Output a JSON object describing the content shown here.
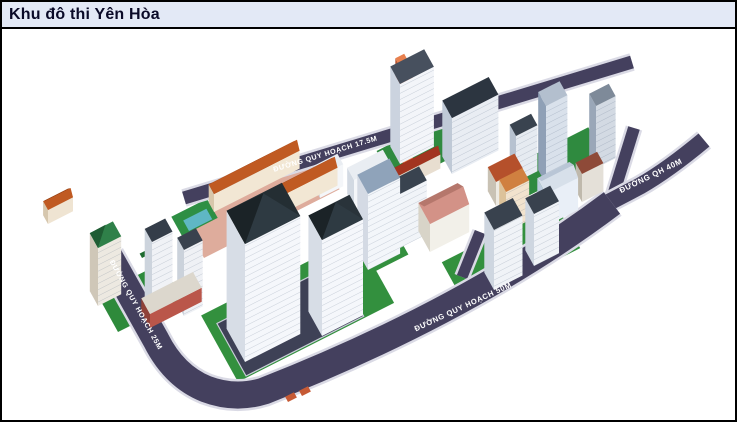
{
  "window": {
    "title": "Khu đô thi Yên Hòa"
  },
  "colors": {
    "titlebar_bg": "#E3E9F6",
    "titlebar_text": "#0A0A28",
    "frame_border": "#000000",
    "canvas_bg": "#FFFFFF",
    "road": "#44405E",
    "sidewalk": "#DADAE5",
    "road_label_text": "#FFFFFF",
    "grass": "#33903E",
    "grass_dark": "#1D6B2F",
    "water": "#5FB7C4",
    "townhouse_roof": "#C05A22",
    "tower_roof_dark": "#27313A",
    "salmon_roof": "#D39287",
    "parking": "#3E4156"
  },
  "scene": {
    "road_labels": [
      {
        "id": "road-label-25m",
        "text": "ĐƯỜNG QUY HOẠCH 25M",
        "x": 134,
        "y": 306,
        "angle": 61,
        "size": 7.2
      },
      {
        "id": "road-label-17-5m",
        "text": "ĐƯỜNG QUY HOẠCH 17.5M",
        "x": 326,
        "y": 156,
        "angle": -17,
        "size": 7.2
      },
      {
        "id": "road-label-50m",
        "text": "ĐƯỜNG QUY HOẠCH 50M",
        "x": 464,
        "y": 309,
        "angle": -25,
        "size": 7.6
      },
      {
        "id": "road-label-40m",
        "text": "ĐƯỜNG QH 40M",
        "x": 652,
        "y": 178,
        "angle": -26,
        "size": 7.8
      }
    ],
    "roads": [
      {
        "name": "road-17-5m",
        "d": "M 184 198 L 632 62",
        "w": 13
      },
      {
        "name": "road-branch-internal",
        "d": "M 462 277 L 480 232",
        "w": 11
      },
      {
        "name": "road-junction-arm",
        "d": "M 611 202 L 634 128",
        "w": 12
      },
      {
        "name": "road-40m",
        "d": "M 600 207 L 640 186 Q 668 170 704 140",
        "w": 17
      },
      {
        "name": "road-25m-50m-loop",
        "d": "M 109 256 L 156 340 Q 174 376 206 389 Q 235 400 264 391 Q 470 310 612 203",
        "w": 27
      }
    ],
    "pads": [
      {
        "name": "lawn-left",
        "x": 118,
        "y": 332,
        "w": 72,
        "d": 42,
        "fill": "#2E8A3B"
      },
      {
        "name": "lawn-central",
        "x": 238,
        "y": 382,
        "w": 175,
        "d": 76,
        "fill": "#33903E"
      },
      {
        "name": "parking-central",
        "x": 246,
        "y": 376,
        "w": 132,
        "d": 60,
        "fill": "#3E4156",
        "stroke": "#C9CCD8"
      },
      {
        "name": "lawn-center-small",
        "x": 362,
        "y": 278,
        "w": 52,
        "d": 30,
        "fill": "#33903E"
      },
      {
        "name": "townhouse-ground",
        "x": 204,
        "y": 258,
        "w": 152,
        "d": 38,
        "fill": "#DEAC9C"
      },
      {
        "name": "lawn-upper-a",
        "x": 396,
        "y": 186,
        "w": 110,
        "d": 40,
        "fill": "#2F8A3F"
      },
      {
        "name": "lawn-upper-b",
        "x": 520,
        "y": 200,
        "w": 95,
        "d": 34,
        "fill": "#2F8A3F"
      },
      {
        "name": "lawn-right",
        "x": 466,
        "y": 306,
        "w": 128,
        "d": 50,
        "fill": "#33903E"
      }
    ],
    "pool": {
      "frame": {
        "x": 182,
        "y": 236,
        "w": 40,
        "d": 22,
        "fill": "#2E8F44"
      },
      "water": {
        "x": 189,
        "y": 231,
        "w": 26,
        "d": 12,
        "fill": "#5FB7C4"
      }
    },
    "trees": [
      {
        "x": 142,
        "y": 258,
        "w": 8,
        "d": 5,
        "fill": "#1D6B2F"
      },
      {
        "x": 150,
        "y": 272,
        "w": 8,
        "d": 5,
        "fill": "#1D6B2F"
      },
      {
        "x": 158,
        "y": 287,
        "w": 8,
        "d": 5,
        "fill": "#1D6B2F"
      },
      {
        "x": 166,
        "y": 301,
        "w": 8,
        "d": 5,
        "fill": "#1D6B2F"
      },
      {
        "x": 288,
        "y": 402,
        "w": 10,
        "d": 6,
        "fill": "#C65A35"
      },
      {
        "x": 302,
        "y": 396,
        "w": 10,
        "d": 6,
        "fill": "#C65A35"
      }
    ],
    "buildings": [
      {
        "name": "villa-row-far-left",
        "x": 48,
        "y": 224,
        "w": 28,
        "d": 10,
        "h": 14,
        "wall": "#EFE4D2",
        "side": "#D6C7AE",
        "roof": "#C05A22",
        "ridge": [
          5,
          "#8F3F16"
        ]
      },
      {
        "name": "tower-cap",
        "x": 404,
        "y": 166,
        "w": 10,
        "d": 18,
        "h": 92,
        "wall": "#E07040",
        "side": "#B85530",
        "roof": "#E8804E"
      },
      {
        "name": "tower-orange-cap",
        "x": 400,
        "y": 164,
        "w": 38,
        "d": 20,
        "h": 80,
        "wall": "#F3F5F9",
        "side": "#CBD3DF",
        "roof": "#47505E",
        "floors": true
      },
      {
        "name": "slab-dark-roof",
        "x": 452,
        "y": 174,
        "w": 52,
        "d": 20,
        "h": 56,
        "wall": "#E9EDF3",
        "side": "#BFC9D6",
        "roof": "#2C3540",
        "floors": true
      },
      {
        "name": "slab-mid",
        "x": 516,
        "y": 182,
        "w": 24,
        "d": 13,
        "h": 46,
        "wall": "#E6EBF1",
        "side": "#B7C2D0",
        "roof": "#39434F",
        "floors": true
      },
      {
        "name": "tower-tall-cap",
        "x": 549,
        "y": 185,
        "w": 11,
        "d": 11,
        "h": 86,
        "wall": "#E8EDF3",
        "side": "#AEBBCB",
        "roof": "#C6CFDA"
      },
      {
        "name": "tower-tall-blue",
        "x": 546,
        "y": 184,
        "w": 24,
        "d": 16,
        "h": 78,
        "wall": "#D9E1EB",
        "side": "#8FA0B6",
        "roof": "#B3BFCE",
        "floors": true
      },
      {
        "name": "tower-gray-rear",
        "x": 596,
        "y": 168,
        "w": 22,
        "d": 14,
        "h": 62,
        "wall": "#D3DAE3",
        "side": "#9AA7B8",
        "roof": "#7E8A99",
        "floors": true
      },
      {
        "name": "school-red-roof",
        "x": 496,
        "y": 206,
        "w": 30,
        "d": 17,
        "h": 24,
        "wall": "#EDEAE2",
        "side": "#C9C2B4",
        "roof": "#B5502B"
      },
      {
        "name": "annex-brown-roof",
        "x": 582,
        "y": 202,
        "w": 24,
        "d": 13,
        "h": 28,
        "wall": "#E4E0D8",
        "side": "#BFB9AC",
        "roof": "#8E4A38"
      },
      {
        "name": "row-red-roof",
        "x": 394,
        "y": 192,
        "w": 52,
        "d": 9,
        "h": 14,
        "wall": "#E8DED0",
        "side": "#C9BCA8",
        "roof": "#A23420",
        "ridge": [
          5,
          "#70200F"
        ]
      },
      {
        "name": "slab-white-a",
        "x": 320,
        "y": 198,
        "w": 26,
        "d": 12,
        "h": 22,
        "wall": "#F4F6F9",
        "side": "#D2D9E2",
        "roof": "#E9EDF2"
      },
      {
        "name": "slab-white-b",
        "x": 354,
        "y": 206,
        "w": 40,
        "d": 14,
        "h": 26,
        "wall": "#F4F6F9",
        "side": "#D2D9E2",
        "roof": "#E9EDF2"
      },
      {
        "name": "townhouse-row-a",
        "x": 214,
        "y": 212,
        "w": 96,
        "d": 11,
        "h": 18,
        "wall": "#F2E7D4",
        "side": "#D8C7AB",
        "roof": "#C05A22",
        "ridge": [
          6,
          "#8F3F16"
        ]
      },
      {
        "name": "school-blue",
        "x": 546,
        "y": 226,
        "w": 36,
        "d": 18,
        "h": 32,
        "wall": "#E9EFF7",
        "side": "#BCCBDD",
        "roof": "#D7E0EA",
        "ridge": [
          5,
          "#B9C6D6"
        ]
      },
      {
        "name": "block-orange-band",
        "x": 506,
        "y": 232,
        "w": 26,
        "d": 14,
        "h": 40,
        "wall": "#F2E3CE",
        "side": "#DCC29A",
        "roof": "#D08040",
        "floors": true
      },
      {
        "name": "townhouse-row-b",
        "x": 234,
        "y": 238,
        "w": 116,
        "d": 11,
        "h": 18,
        "wall": "#F2E7D4",
        "side": "#D8C7AB",
        "roof": "#C05A22",
        "ridge": [
          6,
          "#8F3F16"
        ]
      },
      {
        "name": "slab-center-rear",
        "x": 400,
        "y": 248,
        "w": 30,
        "d": 16,
        "h": 54,
        "wall": "#F1F4F8",
        "side": "#D0D7E1",
        "roof": "#39434F",
        "floors": true
      },
      {
        "name": "community-salmon",
        "x": 430,
        "y": 252,
        "w": 44,
        "d": 24,
        "h": 28,
        "wall": "#F2F0E9",
        "side": "#D8D4C8",
        "roof": "#D39287",
        "ridge": [
          7,
          "#B5776C"
        ]
      },
      {
        "name": "tower-right-b",
        "x": 534,
        "y": 266,
        "w": 28,
        "d": 18,
        "h": 52,
        "wall": "#F0F3F7",
        "side": "#CED6E0",
        "roof": "#39424E",
        "floors": true
      },
      {
        "name": "tower-center",
        "x": 368,
        "y": 270,
        "w": 36,
        "d": 22,
        "h": 76,
        "wall": "#F3F6FA",
        "side": "#D4DAE4",
        "roof": "#8FA3BA",
        "floors": true
      },
      {
        "name": "tower-right-a",
        "x": 494,
        "y": 290,
        "w": 32,
        "d": 20,
        "h": 60,
        "wall": "#F0F3F7",
        "side": "#CED6E0",
        "roof": "#39424E",
        "floors": true
      },
      {
        "name": "tower-green-roof",
        "x": 98,
        "y": 306,
        "w": 26,
        "d": 17,
        "h": 58,
        "wall": "#EDE9E1",
        "side": "#CFC7B8",
        "roof": "#2F8049",
        "gable": [
          "#2F8049",
          "#1F5C33",
          10
        ],
        "floors": true
      },
      {
        "name": "tower-left-b",
        "x": 184,
        "y": 316,
        "w": 21,
        "d": 14,
        "h": 66,
        "wall": "#EFF1F5",
        "side": "#CBD2DB",
        "roof": "#39424E",
        "floors": true
      },
      {
        "name": "tower-left-a",
        "x": 152,
        "y": 320,
        "w": 23,
        "d": 15,
        "h": 78,
        "wall": "#F0F2F6",
        "side": "#CDD4DD",
        "roof": "#343D49",
        "floors": true
      },
      {
        "name": "podium-red-base",
        "x": 150,
        "y": 328,
        "w": 58,
        "d": 18,
        "h": 14,
        "wall": "#BA564A",
        "side": "#8F4138",
        "roof": "#DCD7CD"
      },
      {
        "name": "tower-front-b",
        "x": 322,
        "y": 336,
        "w": 46,
        "d": 28,
        "h": 96,
        "wall": "#F5F7FB",
        "side": "#D7DDE6",
        "roof": "#29333A",
        "gable": [
          "#2E3A42",
          "#1B2327",
          15
        ],
        "floors": true
      },
      {
        "name": "tower-front-a",
        "x": 245,
        "y": 362,
        "w": 62,
        "d": 38,
        "h": 118,
        "wall": "#F5F7FB",
        "side": "#D7DDE6",
        "roof": "#242E33",
        "gable": [
          "#2E3A42",
          "#1B2327",
          20
        ],
        "floors": true
      }
    ]
  }
}
